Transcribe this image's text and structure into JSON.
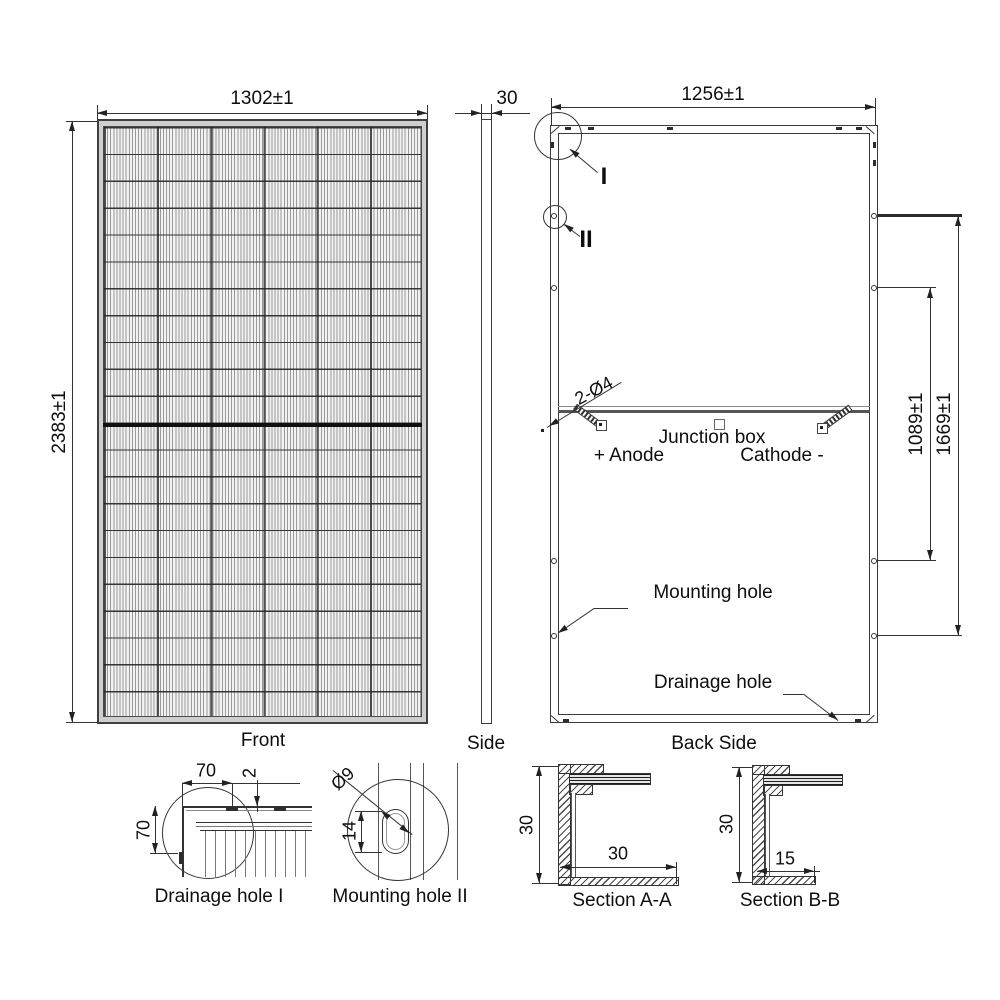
{
  "views": {
    "front": {
      "label": "Front",
      "dim_width": "1302±1",
      "dim_height": "2383±1"
    },
    "side": {
      "label": "Side",
      "dim_thickness": "30"
    },
    "back": {
      "label": "Back Side",
      "dim_width": "1256±1",
      "dim_mount_inner": "1089±1",
      "dim_mount_outer": "1669±1",
      "dim_rail_holes": "2-Ø4",
      "junction_box": "Junction box",
      "anode": "+ Anode",
      "cathode": "Cathode -",
      "mounting_hole": "Mounting hole",
      "drainage_hole": "Drainage hole",
      "detail_i": "I",
      "detail_ii": "II"
    },
    "detail_drainage": {
      "label": "Drainage hole I",
      "dim_width": "70",
      "dim_height": "70",
      "dim_lip": "2"
    },
    "detail_mounting": {
      "label": "Mounting hole II",
      "dim_diameter": "Ø9",
      "dim_length": "14"
    },
    "section_aa": {
      "label": "Section A-A",
      "dim_height": "30",
      "dim_flange": "30"
    },
    "section_bb": {
      "label": "Section B-B",
      "dim_height": "30",
      "dim_flange": "15"
    }
  },
  "colors": {
    "line": "#333333",
    "text": "#0e0e0e",
    "frame_gray": "#cfcfcf",
    "busbar": "#101010"
  }
}
